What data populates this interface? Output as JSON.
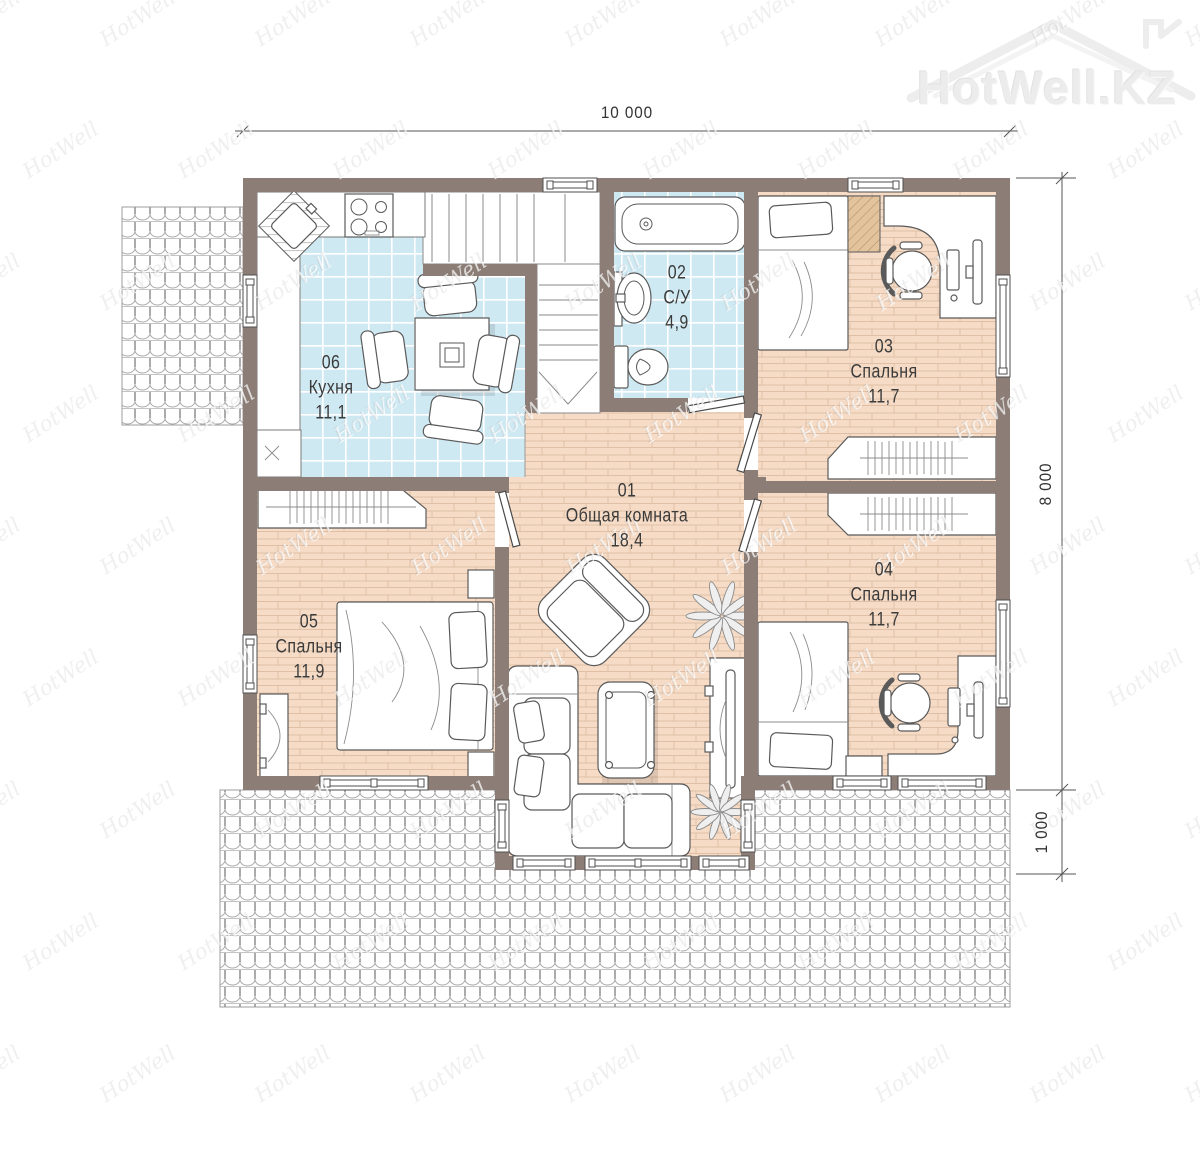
{
  "watermark": {
    "tile_text": "HotWell",
    "logo_text": "HotWell.KZ"
  },
  "dimensions": {
    "width_total": "10 000",
    "height_main": "8 000",
    "height_bay": "1 000"
  },
  "rooms": [
    {
      "id": "01",
      "name": "Общая комната",
      "area": "18,4"
    },
    {
      "id": "02",
      "name": "С/У",
      "area": "4,9"
    },
    {
      "id": "03",
      "name": "Спальня",
      "area": "11,7"
    },
    {
      "id": "04",
      "name": "Спальня",
      "area": "11,7"
    },
    {
      "id": "05",
      "name": "Спальня",
      "area": "11,9"
    },
    {
      "id": "06",
      "name": "Кухня",
      "area": "11,1"
    }
  ],
  "colors": {
    "wall": "#8c7e76",
    "tile": "#cfe9f3",
    "parquet": "#f6dcc6",
    "wood": "#e2c39c"
  }
}
